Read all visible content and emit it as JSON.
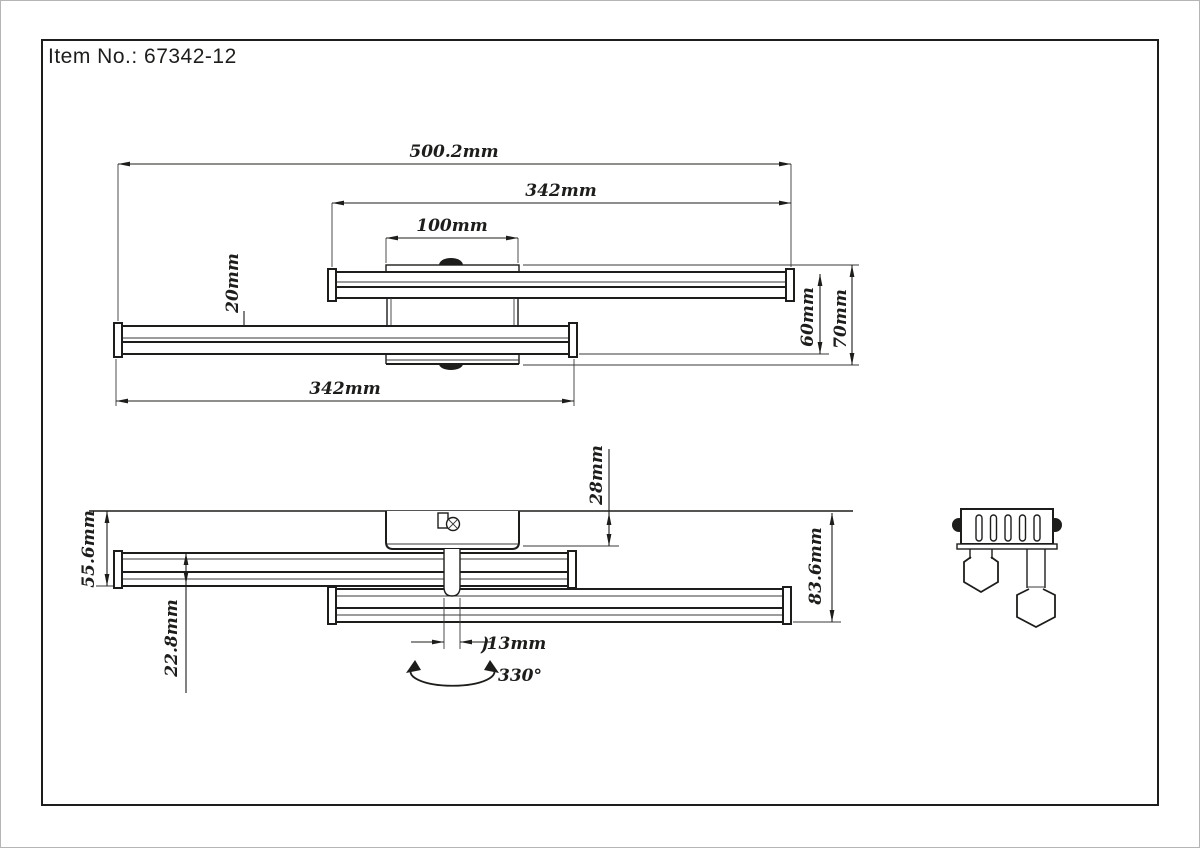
{
  "title": "Item No.: 67342-12",
  "top_view": {
    "overall_width": "500.2mm",
    "upper_bar_length": "342mm",
    "canopy_width": "100mm",
    "bar_depth": "20mm",
    "offset_depth": "60mm",
    "total_depth": "70mm",
    "lower_bar_length": "342mm"
  },
  "side_view": {
    "height_to_first_bar": "55.6mm",
    "bar_profile_height": "22.8mm",
    "canopy_drop": "28mm",
    "total_drop": "83.6mm",
    "stem_diameter": "⦘13mm",
    "swivel_angle": "330°"
  }
}
